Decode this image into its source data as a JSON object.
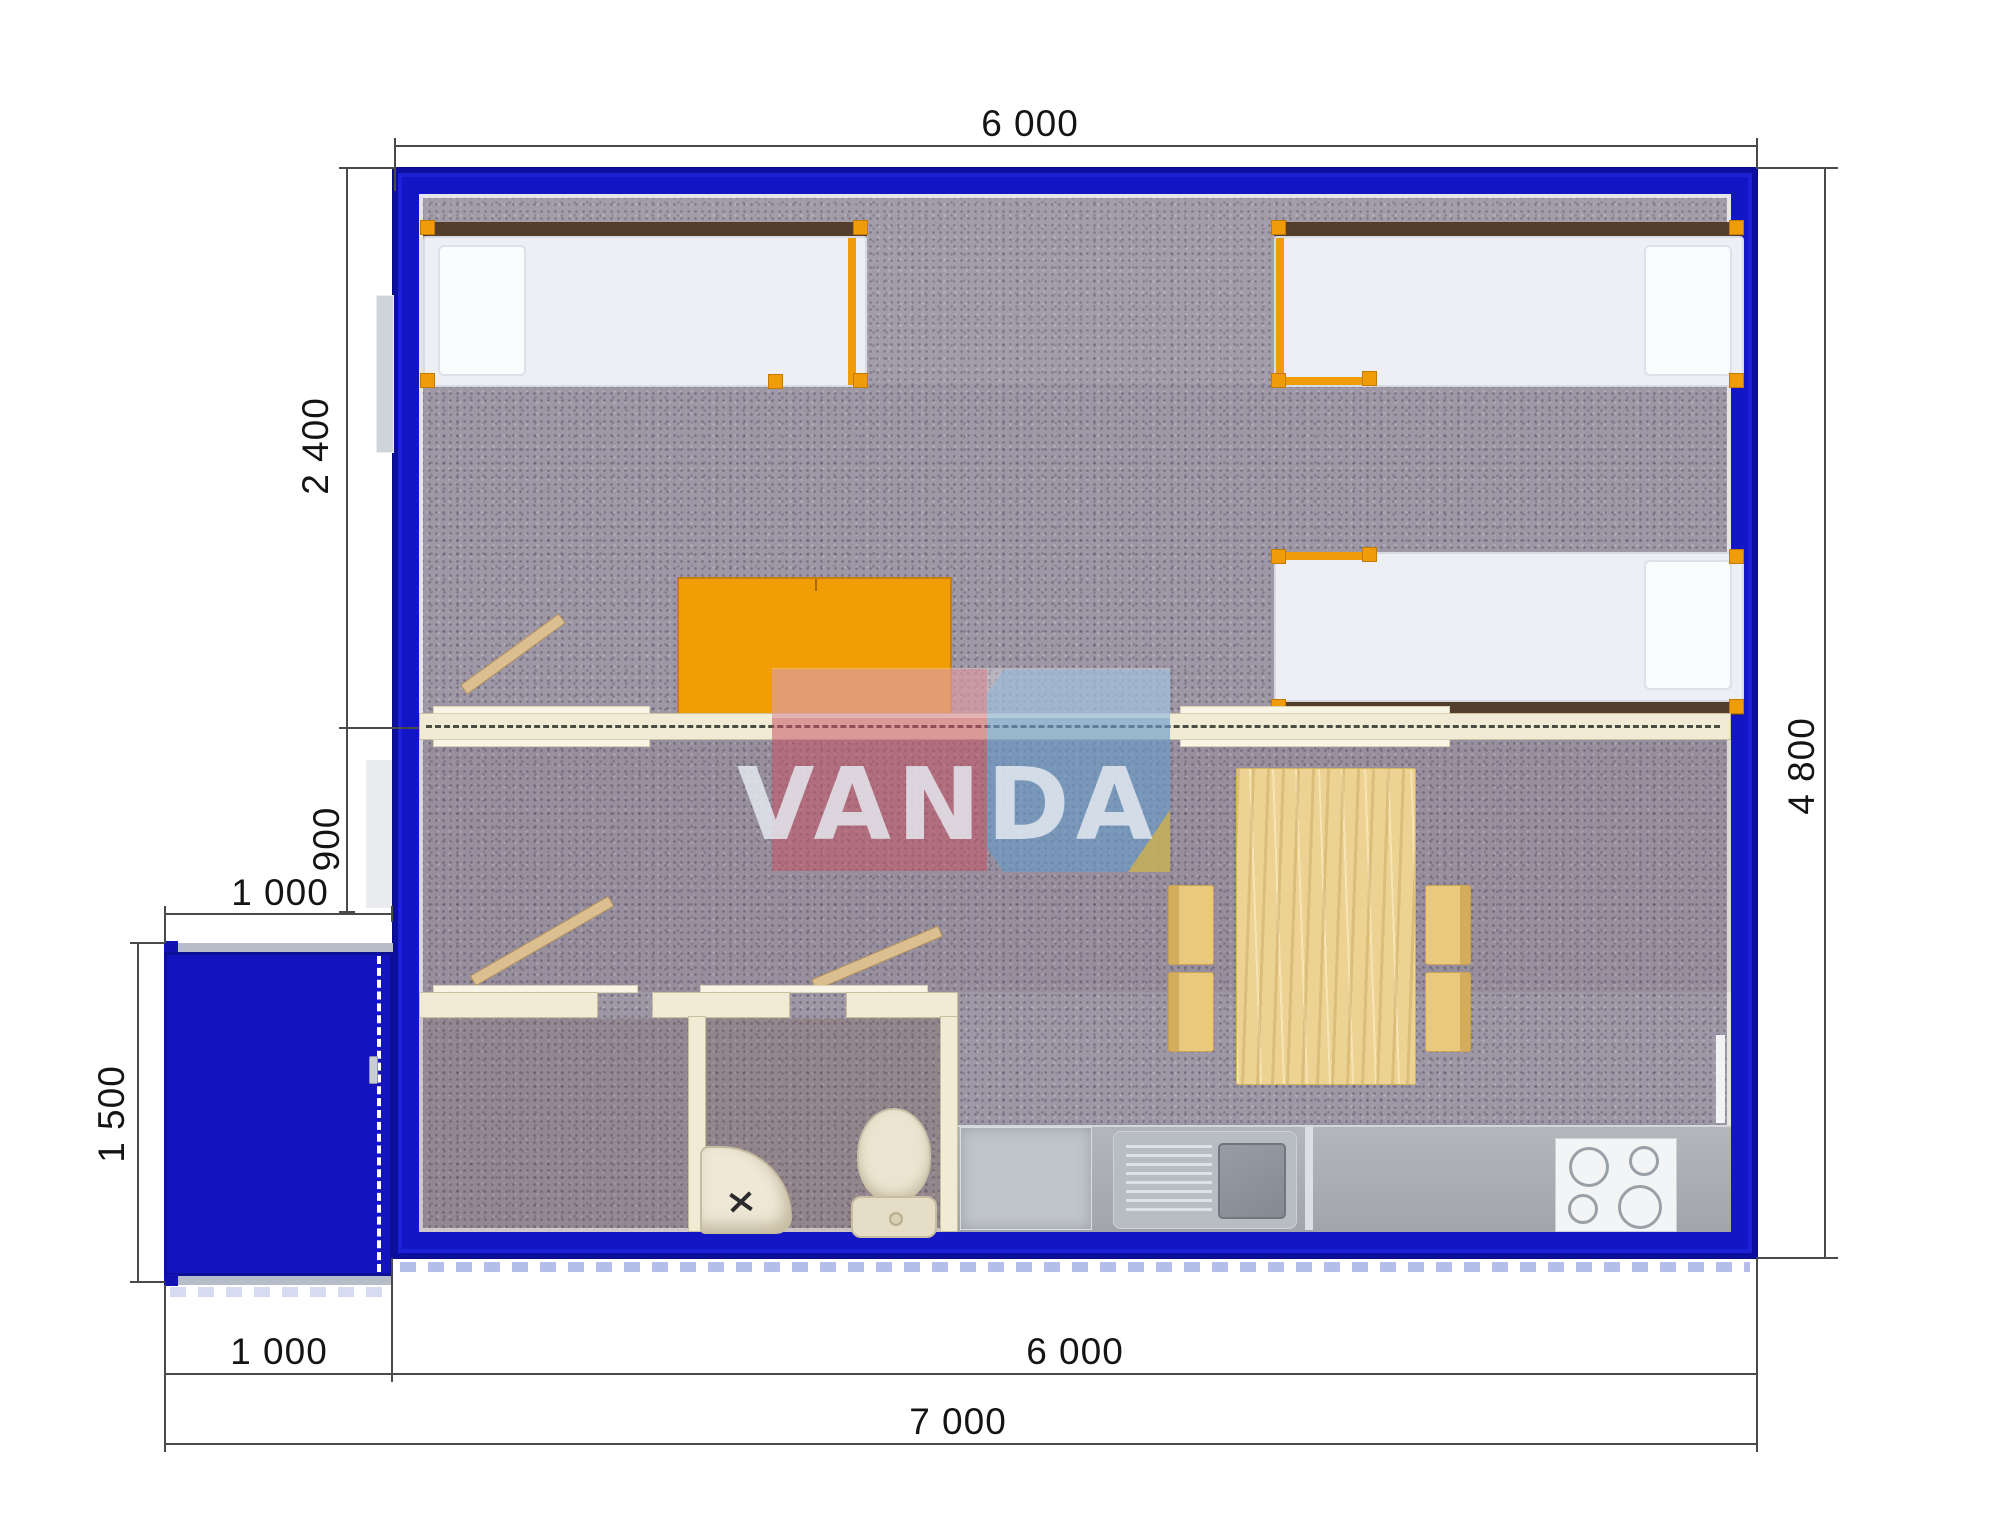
{
  "watermark": {
    "text": "VANDA"
  },
  "dimensions": {
    "top_width": "6 000",
    "right_height": "4 800",
    "bedroom_depth": "2 400",
    "hall_depth": "900",
    "porch_width_top": "1 000",
    "porch_height": "1 500",
    "porch_width_bottom": "1 000",
    "main_width_bottom": "6 000",
    "total_width": "7 000"
  },
  "colors": {
    "wall_blue": "#1316c4",
    "frame_orange": "#ef9c08",
    "partition_cream": "#f1ebd6",
    "carpet": "#9e97a5",
    "counter_gray": "#a9aeb4",
    "wood": "#ead293",
    "watermark_pink": "#c65464",
    "watermark_blue": "#699bc8",
    "watermark_yellow": "#ecbc2c"
  }
}
